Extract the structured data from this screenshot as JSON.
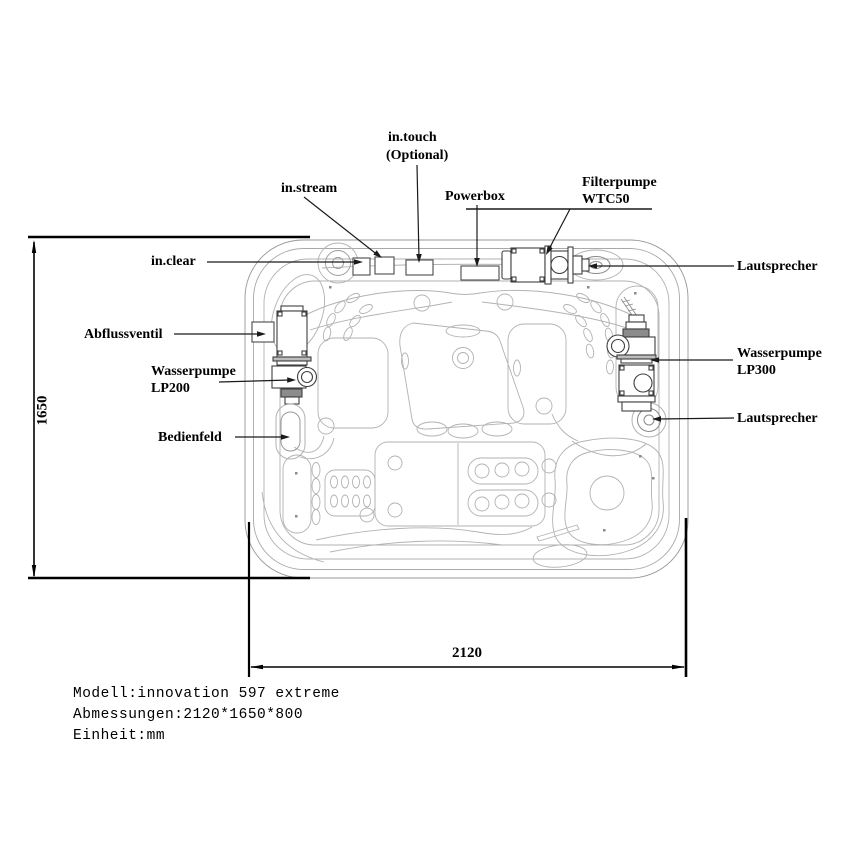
{
  "title": "Spa top view technical drawing",
  "labels": {
    "in_touch": "in.touch",
    "in_touch_optional": "(Optional)",
    "in_stream": "in.stream",
    "powerbox": "Powerbox",
    "filterpumpe": "Filterpumpe",
    "filterpumpe_model": "WTC50",
    "in_clear": "in.clear",
    "lautsprecher_top": "Lautsprecher",
    "abflussventil": "Abflussventil",
    "wasserpumpe_left": "Wasserpumpe",
    "wasserpumpe_left_model": "LP200",
    "bedienfeld": "Bedienfeld",
    "wasserpumpe_right": "Wasserpumpe",
    "wasserpumpe_right_model": "LP300",
    "lautsprecher_bottom": "Lautsprecher"
  },
  "dimensions": {
    "height_mm": "1650",
    "width_mm": "2120"
  },
  "notes": {
    "model": "Modell:innovation 597 extreme",
    "size": "Abmessungen:2120*1650*800",
    "unit": "Einheit:mm"
  },
  "colors": {
    "contour_line": "#a9a9a9",
    "equipment_line": "#3f3f3f",
    "annotation": "#000000",
    "background": "#ffffff"
  }
}
